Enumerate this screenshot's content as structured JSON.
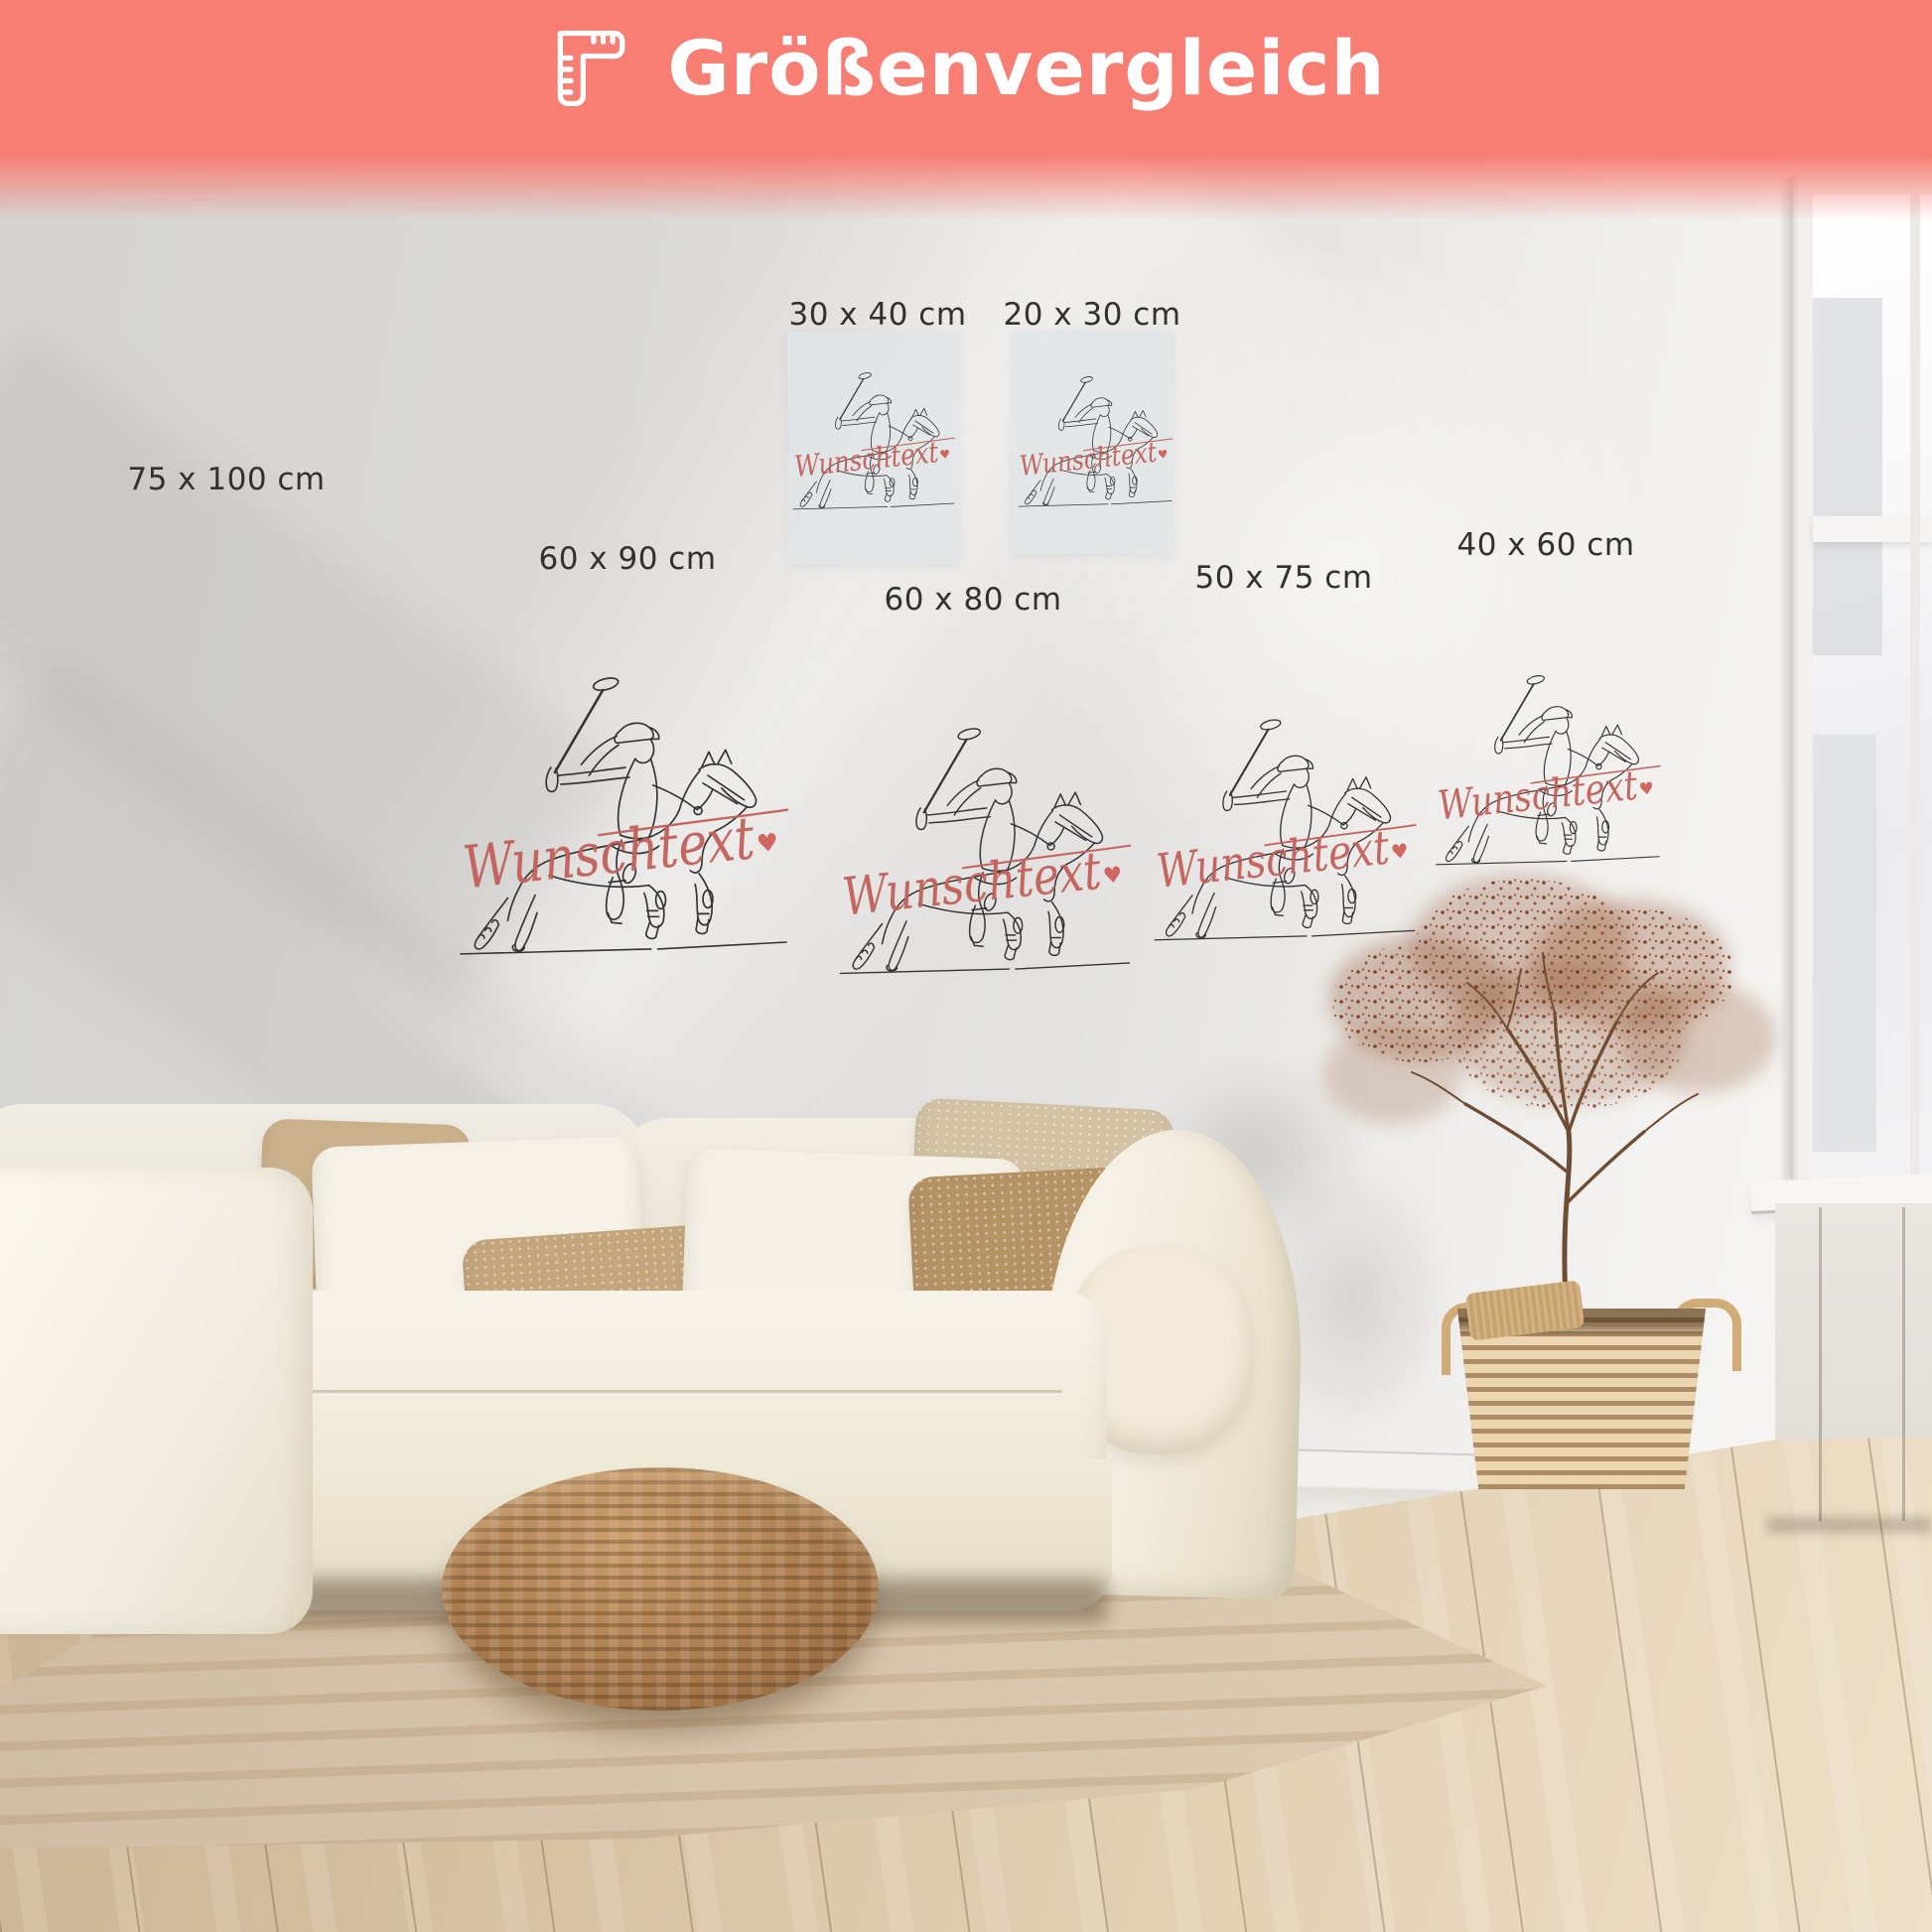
{
  "header": {
    "title": "Größenvergleich",
    "icon": "ruler-icon",
    "banner_color": "#f87d73",
    "text_color": "#ffffff"
  },
  "artwork": {
    "subject": "polo-player-on-horse-line-art",
    "custom_text": "Wunschtext",
    "heart": "♥",
    "script_color": "#c2605a",
    "line_color": "#343434"
  },
  "sizes": [
    {
      "id": "75x100",
      "label": "75 x 100 cm"
    },
    {
      "id": "30x40",
      "label": "30 x 40 cm"
    },
    {
      "id": "20x30",
      "label": "20 x 30 cm"
    },
    {
      "id": "60x90",
      "label": "60 x 90 cm"
    },
    {
      "id": "60x80",
      "label": "60 x 80 cm"
    },
    {
      "id": "50x75",
      "label": "50 x 75 cm"
    },
    {
      "id": "40x60",
      "label": "40 x 60 cm"
    }
  ]
}
